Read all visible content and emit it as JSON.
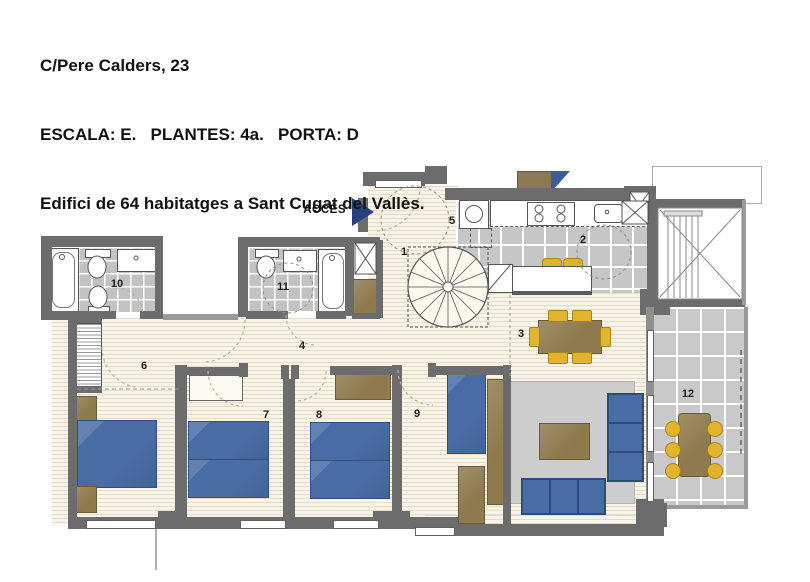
{
  "header": {
    "line1": "C/Pere Calders, 23",
    "line2": "ESCALA: E.   PLANTES: 4a.   PORTA: D",
    "line3": "Edifici de 64 habitatges a Sant Cugat del Vallès."
  },
  "plan": {
    "access_label": "ACCÉS",
    "rooms": [
      {
        "id": "entry-hall",
        "label": "1"
      },
      {
        "id": "kitchen",
        "label": "2"
      },
      {
        "id": "living-dining",
        "label": "3"
      },
      {
        "id": "corridor",
        "label": "4"
      },
      {
        "id": "laundry",
        "label": "5"
      },
      {
        "id": "bedroom-6",
        "label": "6"
      },
      {
        "id": "bedroom-7",
        "label": "7"
      },
      {
        "id": "bedroom-8",
        "label": "8"
      },
      {
        "id": "bedroom-9",
        "label": "9"
      },
      {
        "id": "bathroom-10",
        "label": "10"
      },
      {
        "id": "bathroom-11",
        "label": "11"
      },
      {
        "id": "terrace-12",
        "label": "12"
      }
    ],
    "colors": {
      "wall": "#6c6c6c",
      "wood_floor": "#f8f4e8",
      "tile_floor": "#c5c5c5",
      "furniture_blue": "#4a6ca4",
      "furniture_brown": "#8e7a4d",
      "chair_yellow": "#e2b32c",
      "access_arrow_blue": "#24417e",
      "compass_blue": "#3c5d9c"
    }
  }
}
